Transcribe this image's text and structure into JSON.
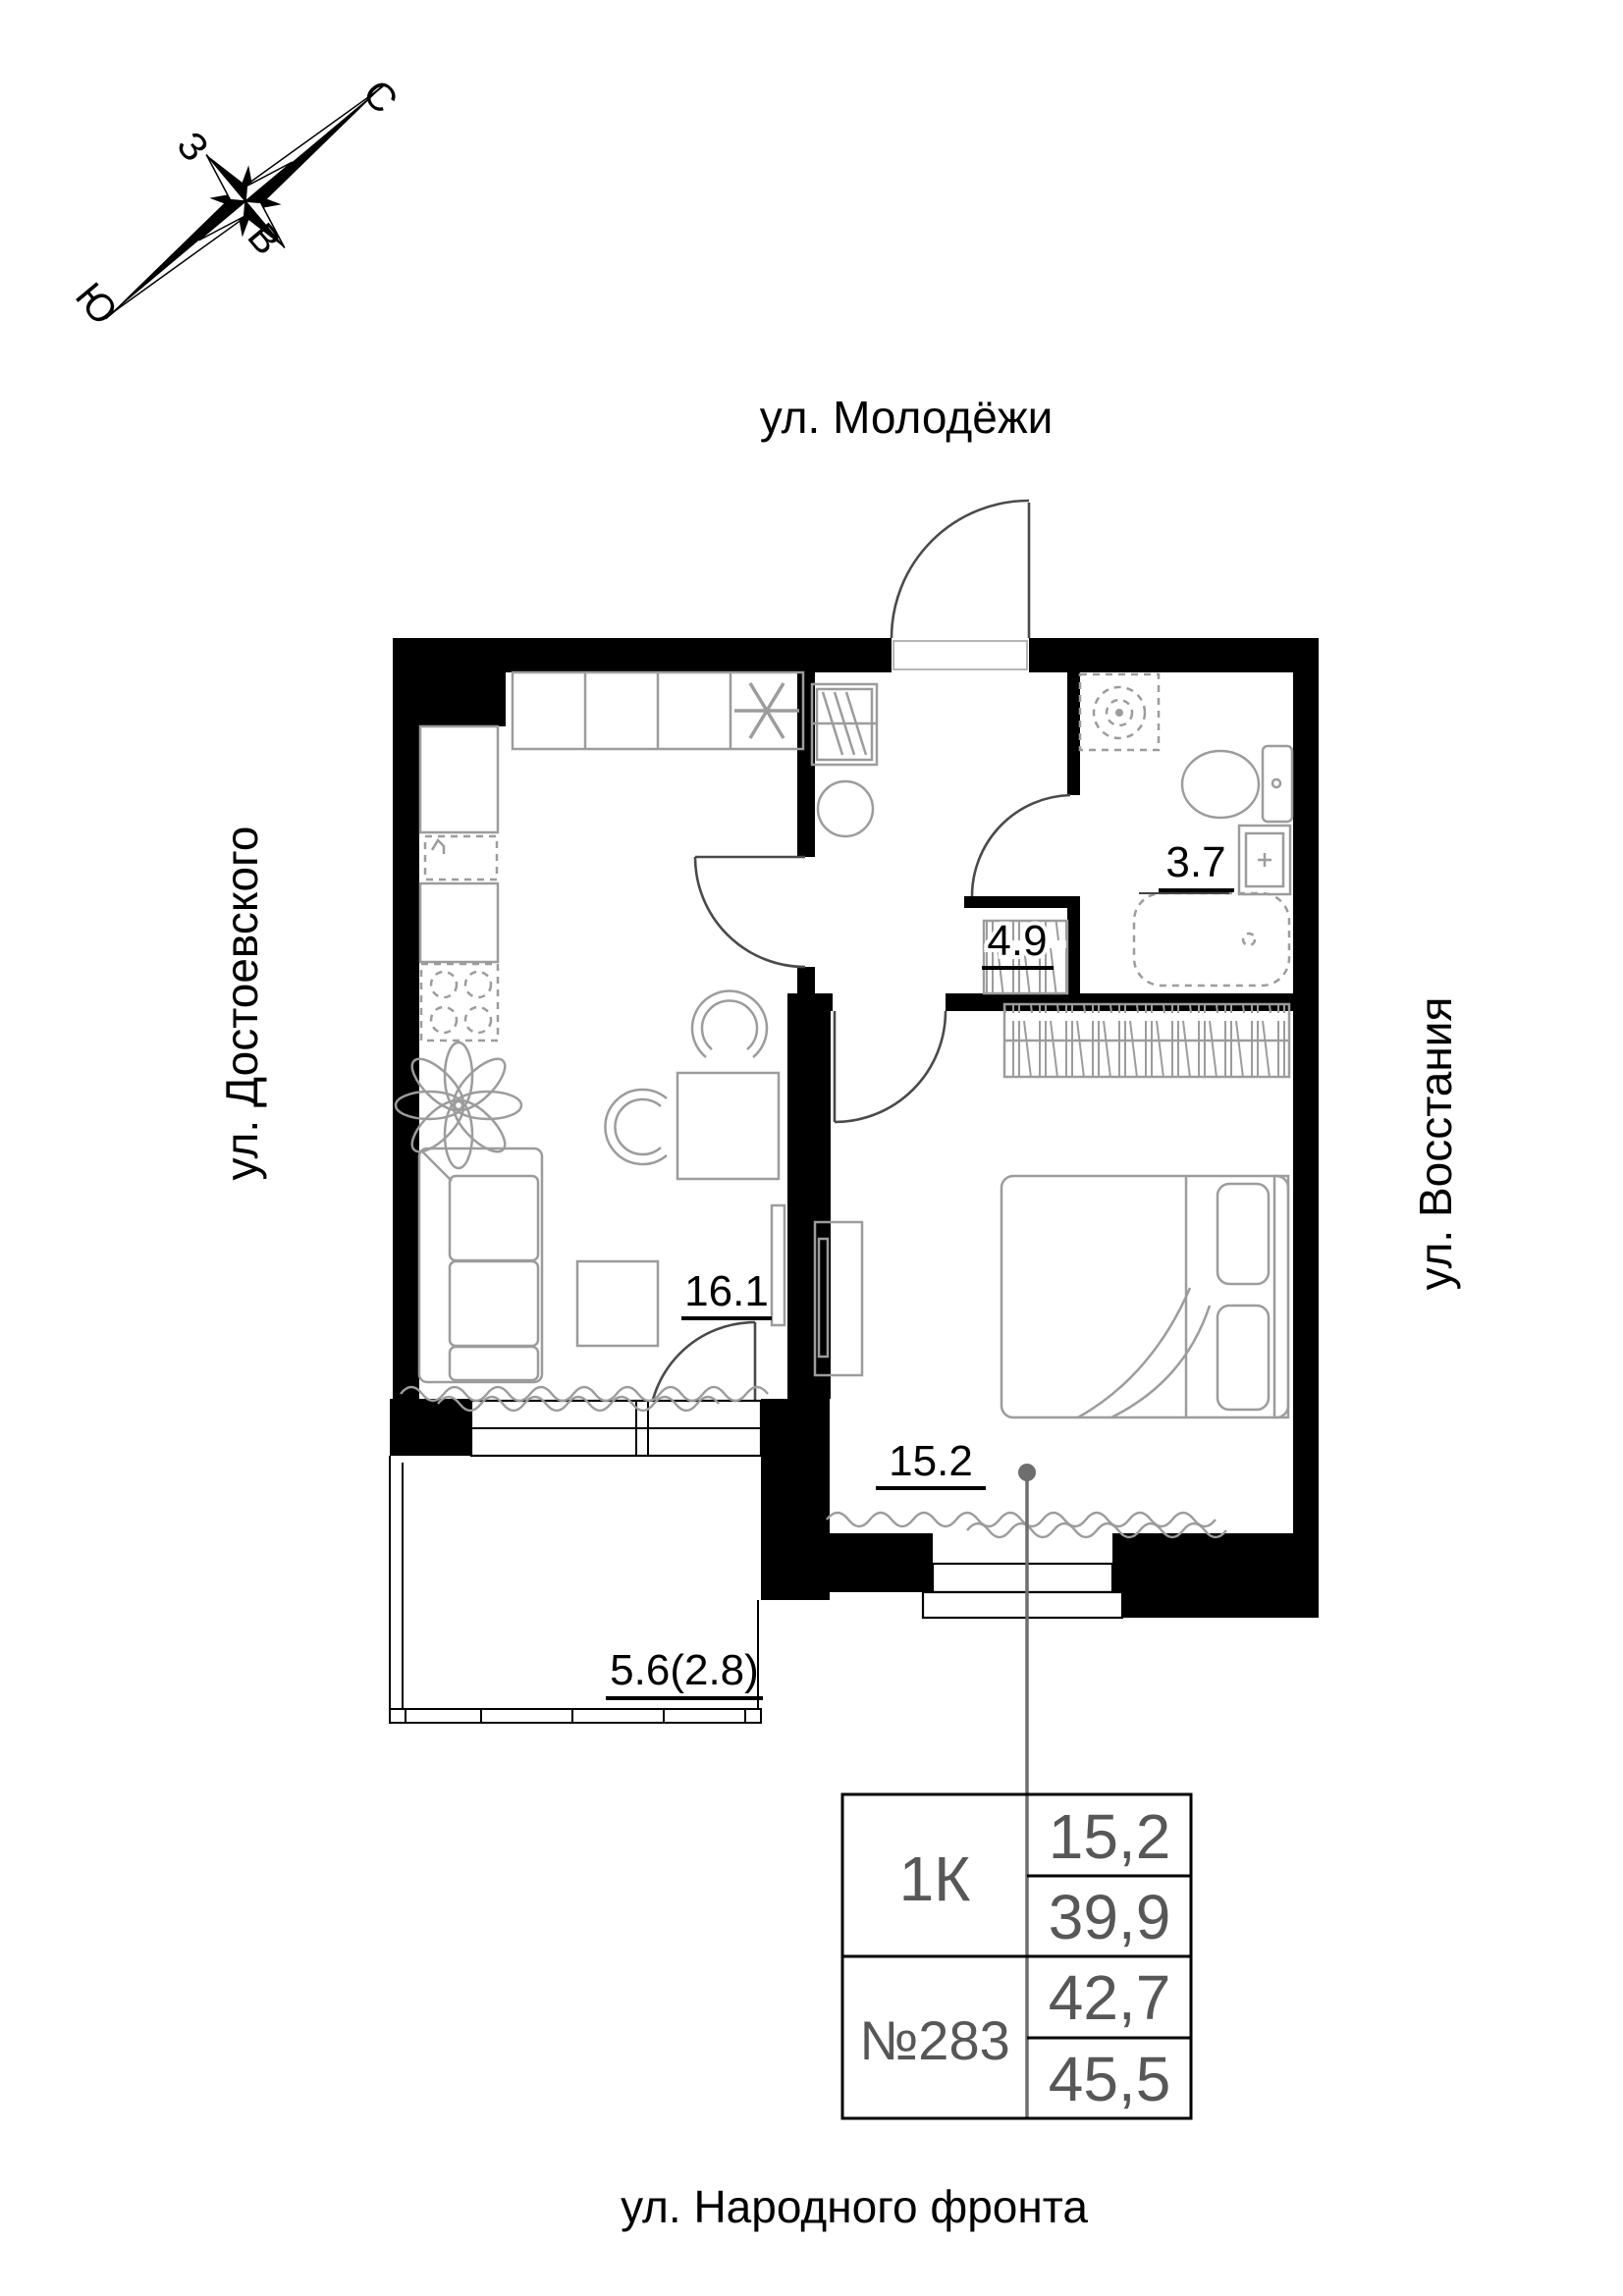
{
  "compass": {
    "north": "С",
    "south": "Ю",
    "west": "З",
    "east": "В"
  },
  "streets": {
    "top": "ул. Молодёжи",
    "left": "ул. Достоевского",
    "right": "ул. Восстания",
    "bottom": "ул. Народного фронта"
  },
  "rooms": {
    "kitchen_living": {
      "area": "16.1"
    },
    "bedroom": {
      "area": "15.2"
    },
    "hallway": {
      "area": "4.9"
    },
    "bathroom": {
      "area": "3.7"
    },
    "balcony": {
      "area": "5.6(2.8)"
    }
  },
  "info_table": {
    "apartment_type": "1К",
    "apartment_number": "№283",
    "rows": {
      "living_area": "15,2",
      "area_without_balcony": "39,9",
      "area_with_reduced_balcony": "42,7",
      "area_total": "45,5"
    }
  },
  "colors": {
    "walls": "#000000",
    "furniture": "#9c9c9c",
    "doors": "#4a4a4a",
    "table_text": "#575757",
    "leader_line": "#6e6e6e",
    "background": "#ffffff"
  }
}
